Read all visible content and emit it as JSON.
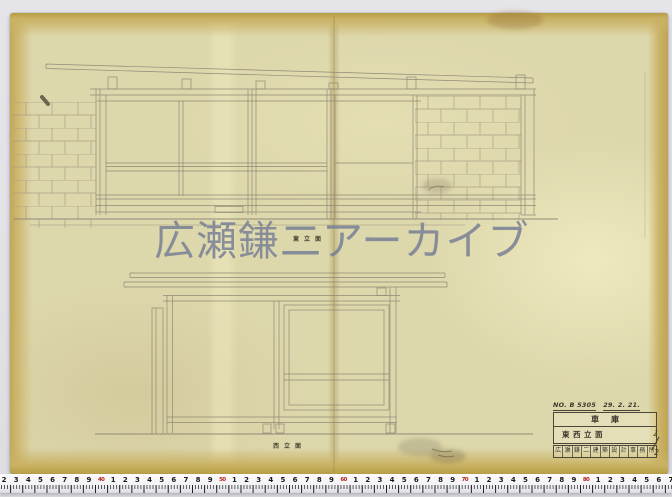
{
  "photo": {
    "watermark": "広瀬鎌二アーカイブ"
  },
  "drawing": {
    "upper_caption": "東立面",
    "lower_caption": "西立面"
  },
  "title_block": {
    "no": "NO. B 5305",
    "date": "29. 2. 21.",
    "project": "車庫",
    "sheet_title": "東西立面",
    "office_stamp": "広瀬鎌二建築設計事務所",
    "sheet_numerator": "1",
    "sheet_denominator": "2"
  },
  "ruler": {
    "digits": [
      "2",
      "3",
      "4",
      "5",
      "6",
      "7",
      "8",
      "9",
      "40",
      "1",
      "2",
      "3",
      "4",
      "5",
      "6",
      "7",
      "8",
      "9",
      "50",
      "1",
      "2",
      "3",
      "4",
      "5",
      "6",
      "7",
      "8",
      "9",
      "60",
      "1",
      "2",
      "3",
      "4",
      "5",
      "6",
      "7",
      "8",
      "9",
      "70",
      "1",
      "2",
      "3",
      "4",
      "5",
      "6",
      "7",
      "8",
      "9",
      "80",
      "1",
      "2",
      "3",
      "4",
      "5",
      "6",
      "7"
    ],
    "red_tens_color": "#b3261e"
  },
  "colors": {
    "background": "#e3e2e7",
    "paper": "#ddd7ac",
    "paper_edge": "#c2a958",
    "pencil": "#8b8473",
    "watermark": "#747c94"
  }
}
